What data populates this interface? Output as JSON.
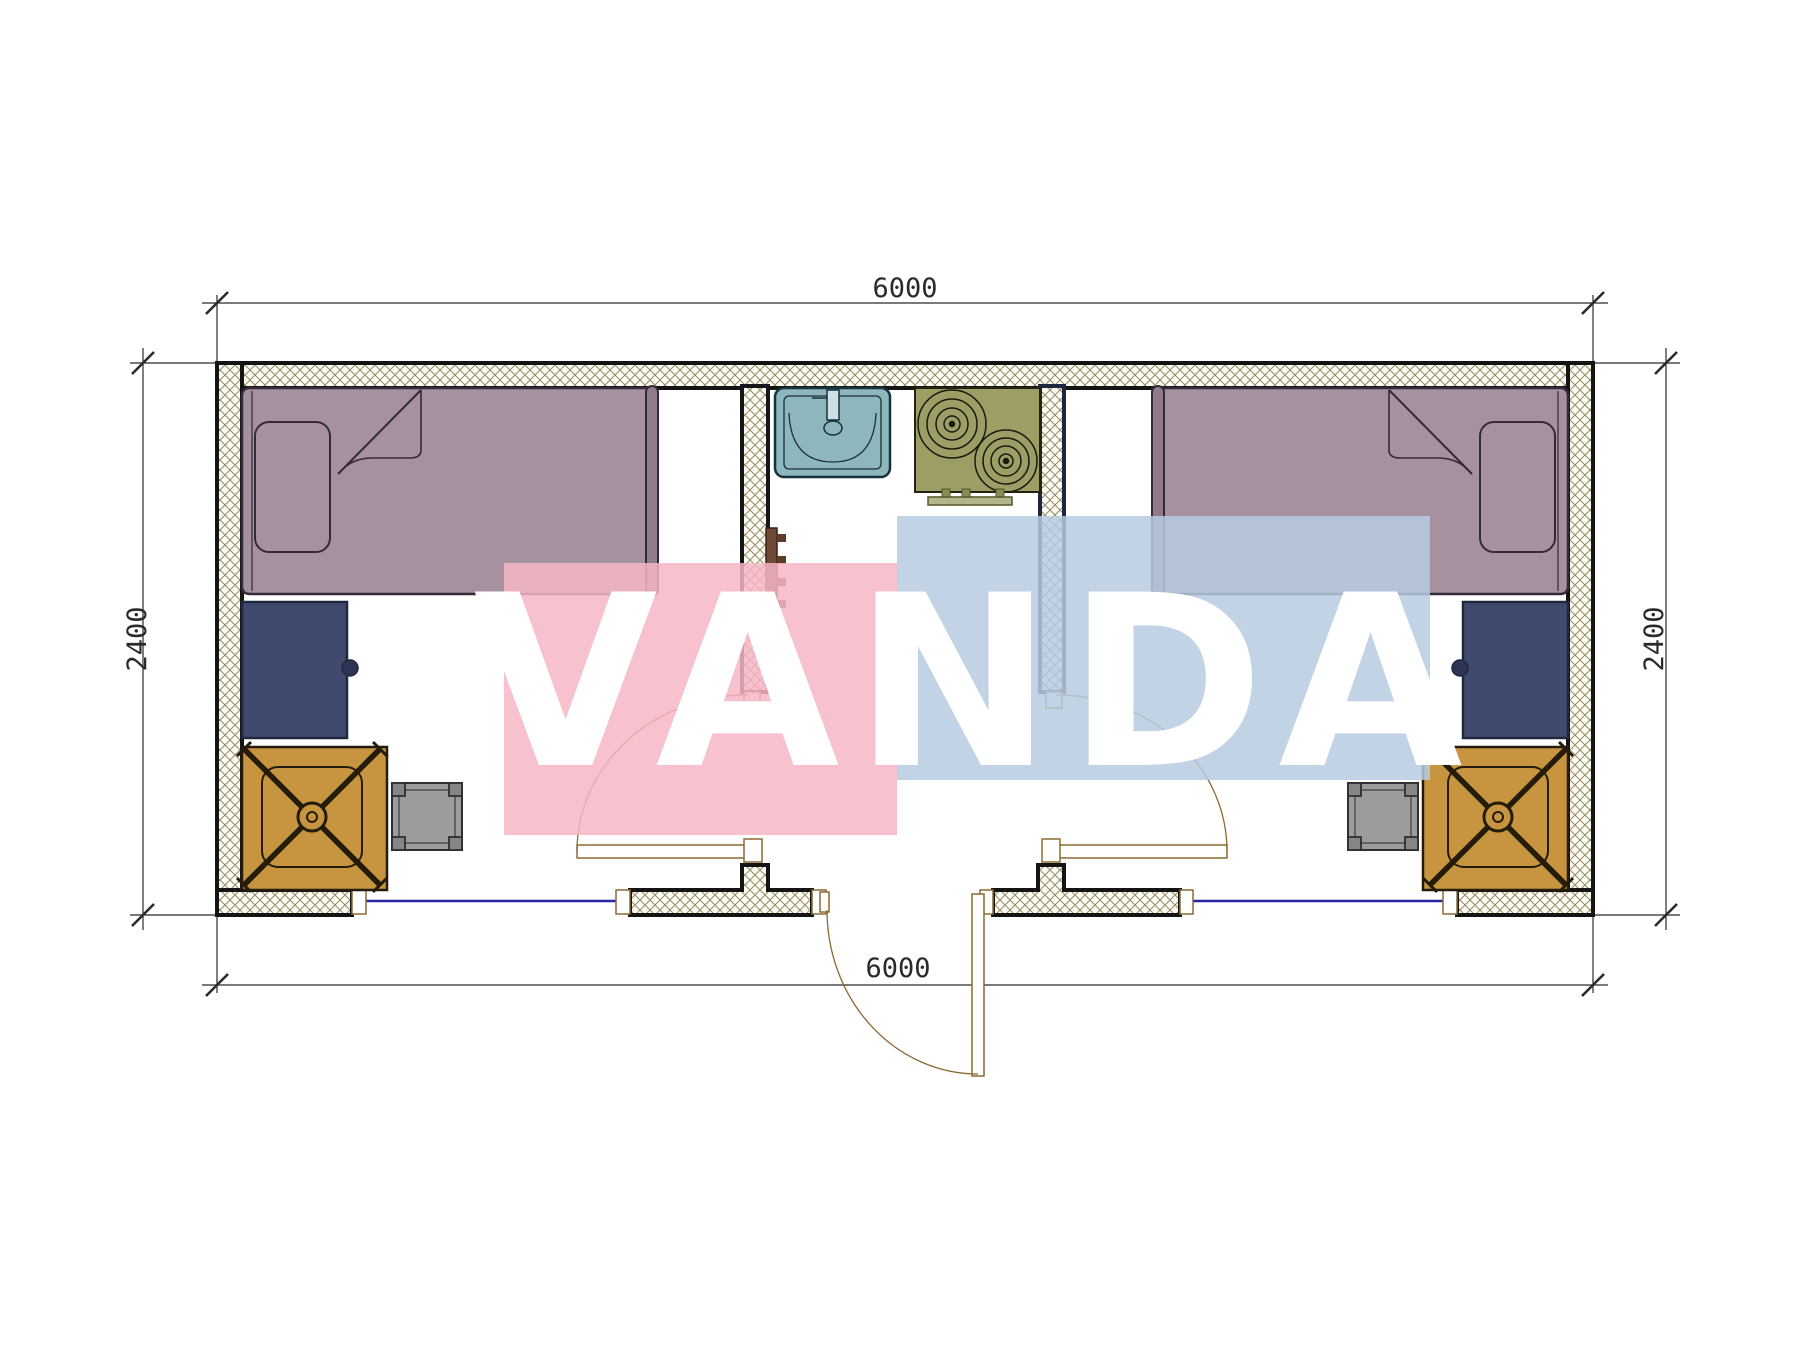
{
  "drawing": {
    "kind": "architectural-floor-plan",
    "dimensions": {
      "top": "6000",
      "bottom": "6000",
      "left": "2400",
      "right": "2400"
    },
    "watermark": {
      "text": "VANDA",
      "pink_block_color": "#f6b6c6",
      "blue_block_color": "#b6cbe0"
    },
    "colors": {
      "wall_line": "#141414",
      "wall_hatch": "#968c63",
      "bed_fill": "#a5919f",
      "footboard_fill": "#8f7b8b",
      "desk_fill": "#404a6e",
      "chair_mat_fill": "#c79440",
      "stool_fill": "#9c9c9c",
      "sink_fill": "#8db6bd",
      "stove_fill": "#9d9d66",
      "radiator_fill": "#6f4a36",
      "window_line": "#2626a0",
      "door_line": "#8a6a33"
    },
    "elements": [
      "exterior-walls",
      "partition-wall-left",
      "partition-wall-right",
      "window-left",
      "window-right",
      "entrance-door",
      "door-left-room",
      "door-right-room",
      "bed-left",
      "bed-right",
      "pillow-left",
      "pillow-right",
      "desk-left",
      "desk-right",
      "chair-left",
      "chair-right",
      "chair-mat-left",
      "chair-mat-right",
      "stool-left",
      "stool-right",
      "sink",
      "stove",
      "radiator"
    ]
  }
}
